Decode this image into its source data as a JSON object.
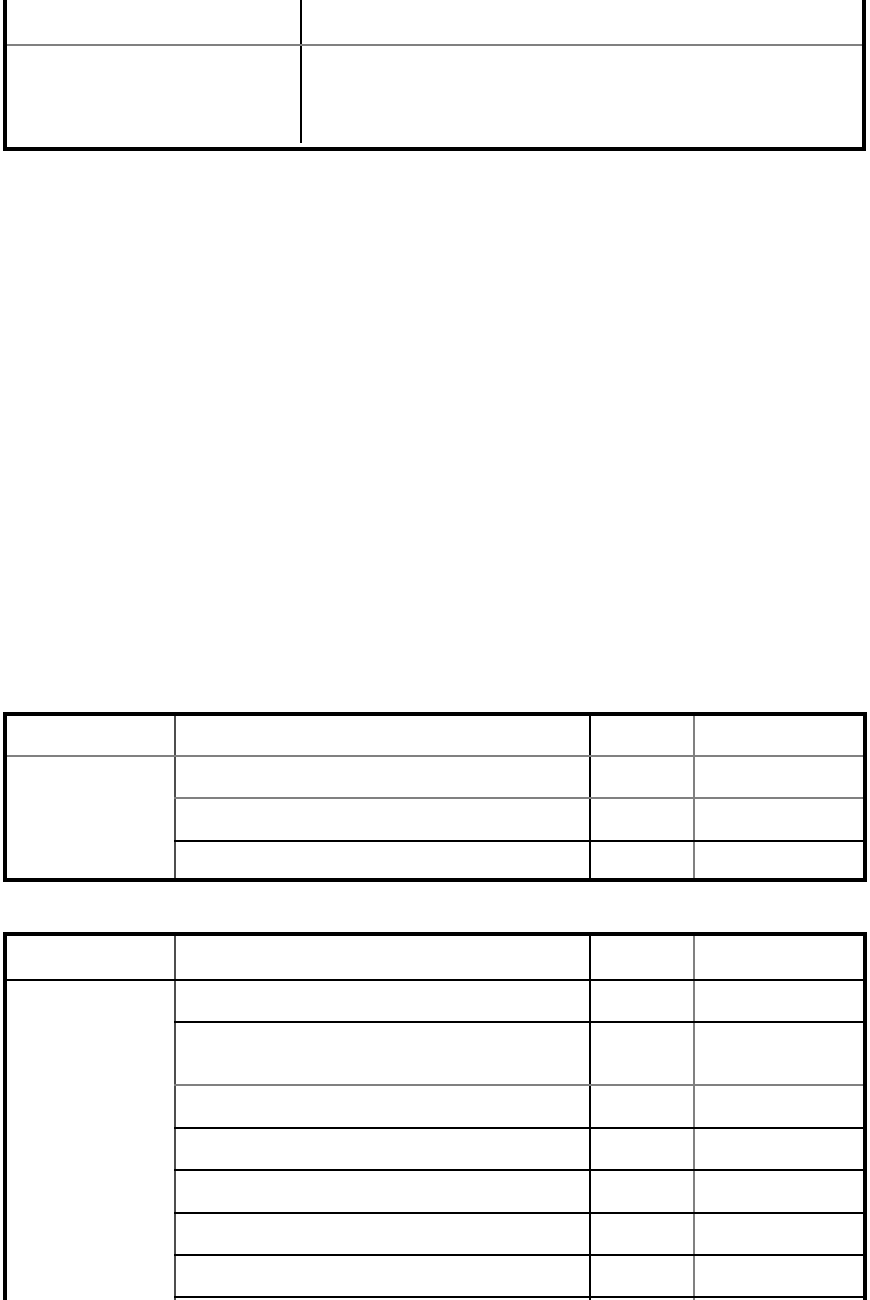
{
  "page": {
    "background_color": "#ffffff"
  },
  "colors": {
    "table_outer_border": "#000000",
    "grid_line_black": "#000000",
    "grid_line_gray": "#808080"
  },
  "tables": {
    "top": {
      "rows": [
        {
          "cells": [
            "",
            ""
          ]
        },
        {
          "cells": [
            "",
            ""
          ]
        }
      ]
    },
    "middle": {
      "header_cells": [
        "",
        "",
        "",
        ""
      ],
      "left_column_cell": "",
      "rows": [
        {
          "cells": [
            "",
            "",
            ""
          ]
        },
        {
          "cells": [
            "",
            "",
            ""
          ]
        },
        {
          "cells": [
            "",
            "",
            ""
          ]
        }
      ]
    },
    "bottom": {
      "header_cells": [
        "",
        "",
        "",
        ""
      ],
      "left_column_cell": "",
      "rows": [
        {
          "cells": [
            "",
            "",
            ""
          ]
        },
        {
          "cells": [
            "",
            "",
            ""
          ]
        },
        {
          "cells": [
            "",
            "",
            ""
          ]
        },
        {
          "cells": [
            "",
            "",
            ""
          ]
        },
        {
          "cells": [
            "",
            "",
            ""
          ]
        },
        {
          "cells": [
            "",
            "",
            ""
          ]
        },
        {
          "cells": [
            "",
            "",
            ""
          ]
        },
        {
          "cells": [
            "",
            "",
            ""
          ]
        }
      ]
    }
  }
}
